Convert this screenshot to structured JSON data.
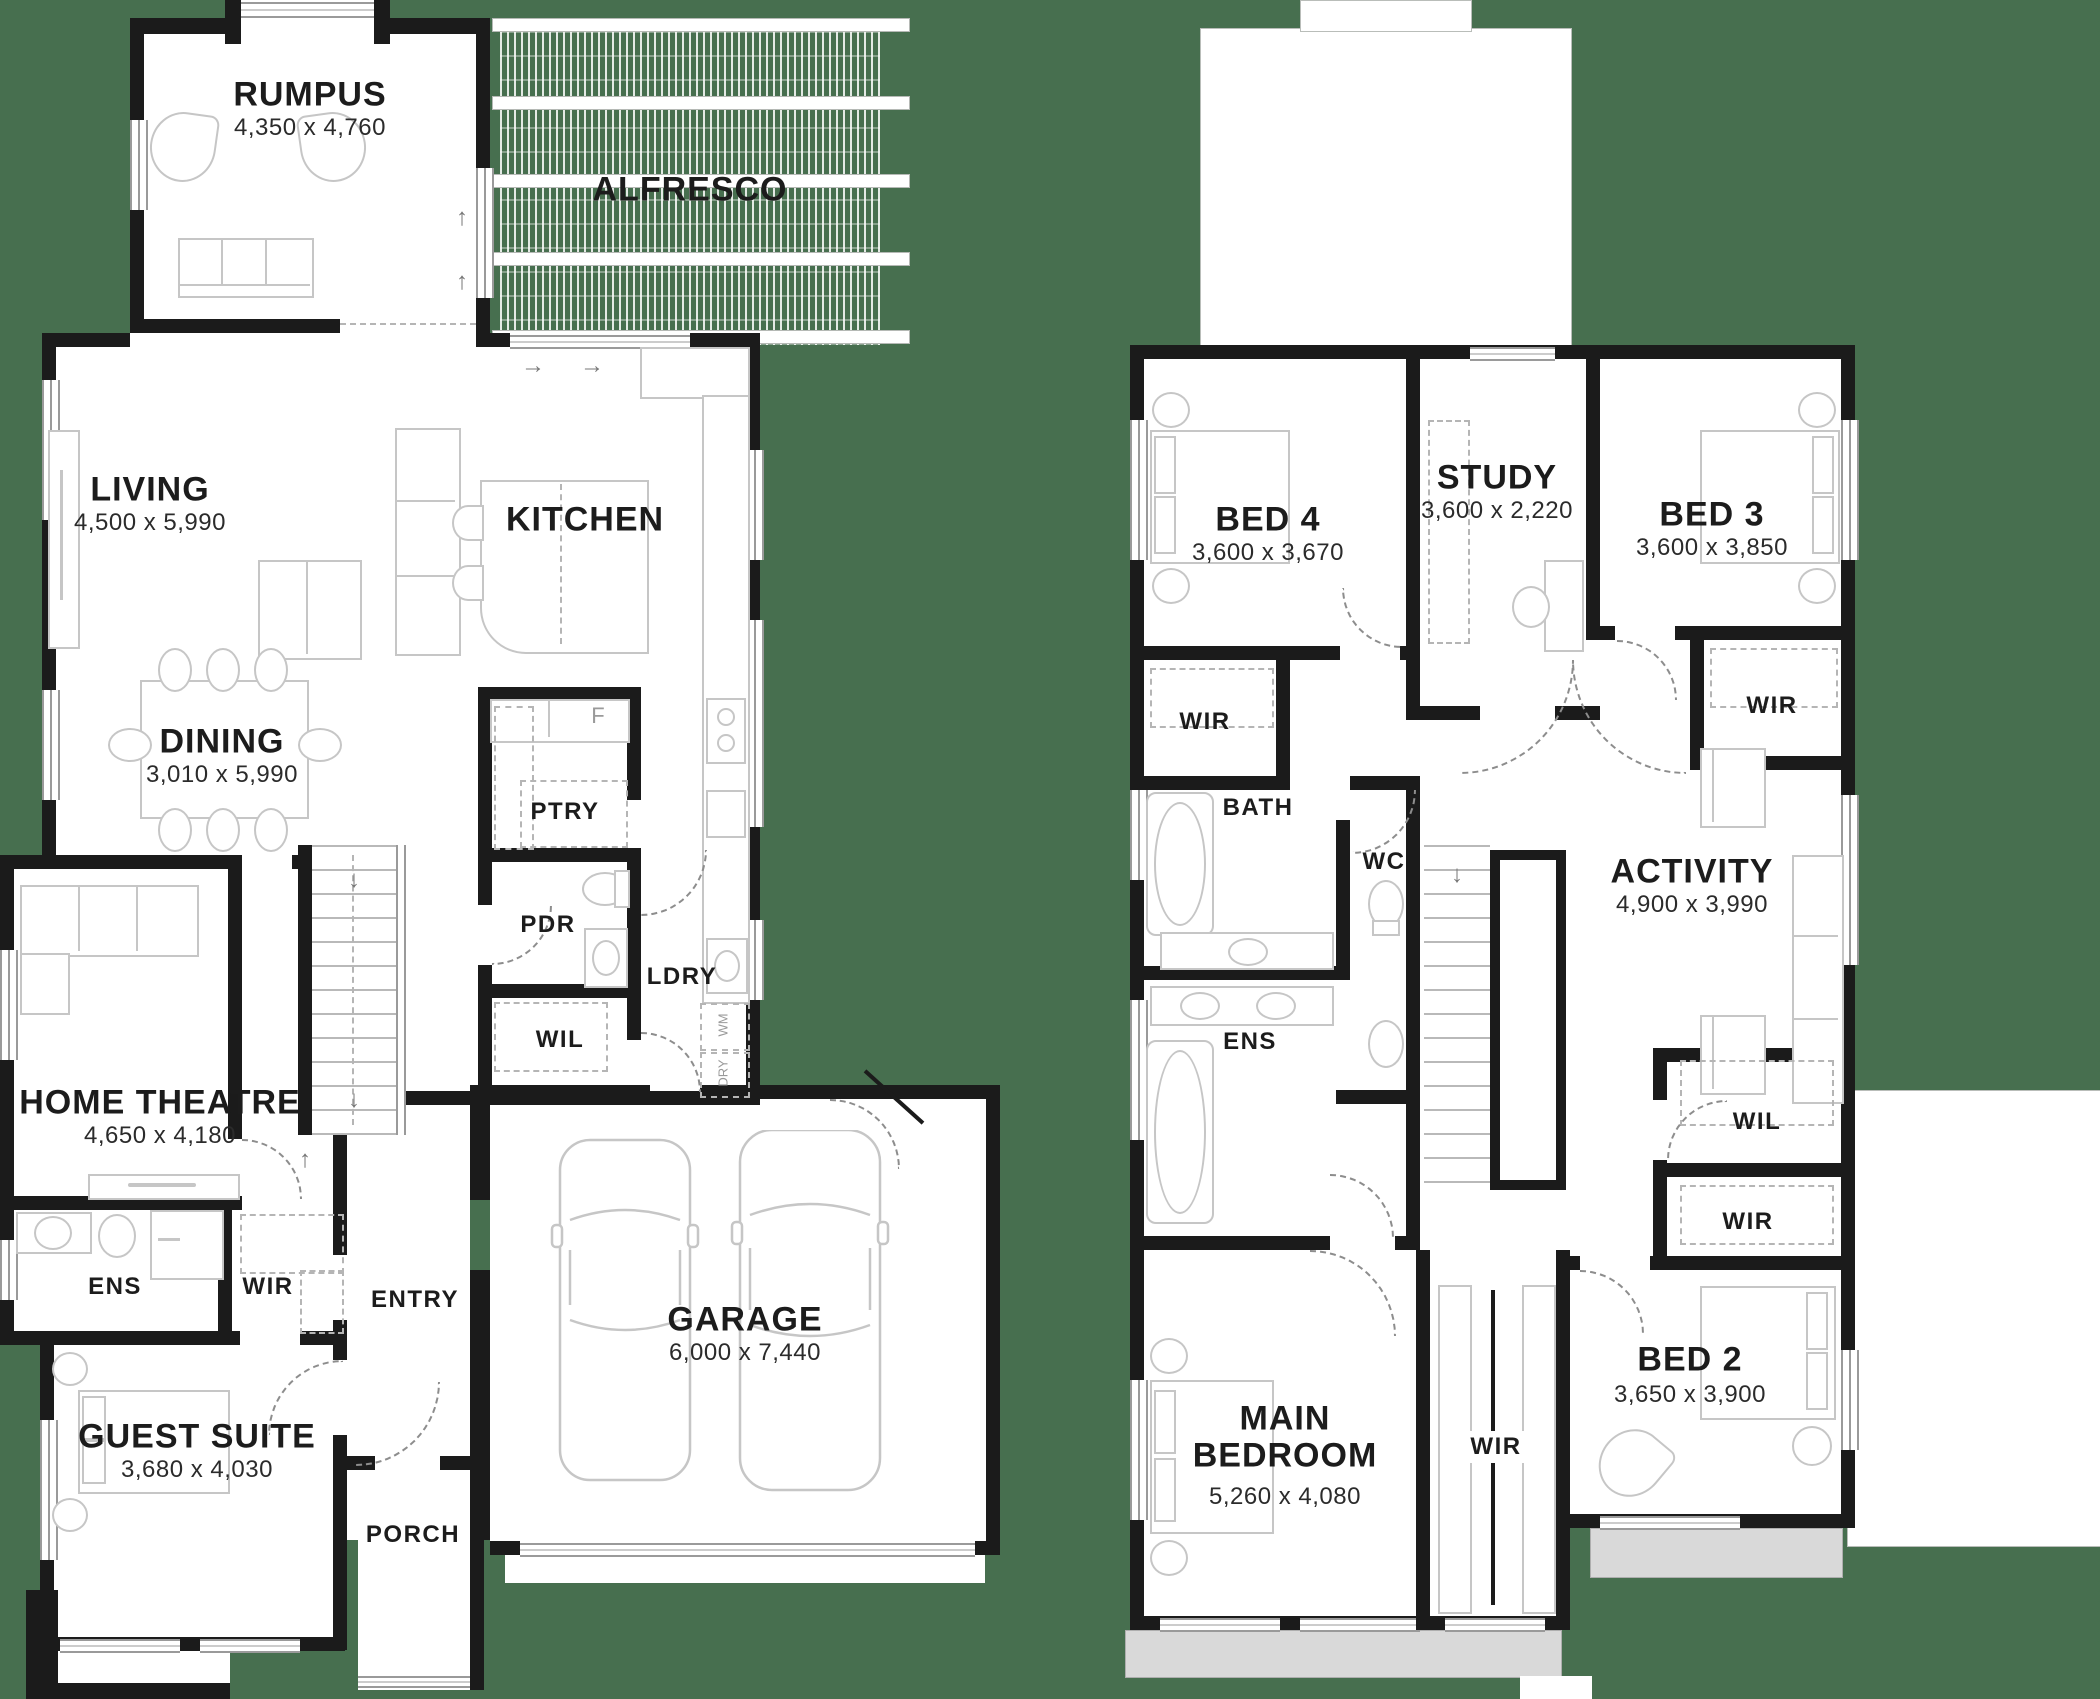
{
  "colors": {
    "background": "#476f4f",
    "wall": "#1b1b1b",
    "floor": "#ffffff",
    "furniture_line": "#c6c6c6",
    "veranda": "#d9d9d9"
  },
  "ground_floor": {
    "rumpus": {
      "name": "RUMPUS",
      "dims": "4,350 x 4,760"
    },
    "alfresco": {
      "name": "ALFRESCO"
    },
    "living": {
      "name": "LIVING",
      "dims": "4,500 x 5,990"
    },
    "dining": {
      "name": "DINING",
      "dims": "3,010 x 5,990"
    },
    "kitchen": {
      "name": "KITCHEN"
    },
    "fridge": {
      "name": "F"
    },
    "pantry": {
      "name": "PTRY"
    },
    "powder": {
      "name": "PDR"
    },
    "laundry": {
      "name": "LDRY"
    },
    "washer": {
      "name": "WM"
    },
    "dryer": {
      "name": "DRY"
    },
    "linen": {
      "name": "WIL"
    },
    "home_theatre": {
      "name": "HOME THEATRE",
      "dims": "4,650 x 4,180"
    },
    "ensuite": {
      "name": "ENS"
    },
    "wardrobe": {
      "name": "WIR"
    },
    "entry": {
      "name": "ENTRY"
    },
    "guest_suite": {
      "name": "GUEST SUITE",
      "dims": "3,680 x 4,030"
    },
    "porch": {
      "name": "PORCH"
    },
    "garage": {
      "name": "GARAGE",
      "dims": "6,000 x 7,440"
    }
  },
  "first_floor": {
    "bed4": {
      "name": "BED 4",
      "dims": "3,600 x 3,670"
    },
    "study": {
      "name": "STUDY",
      "dims": "3,600 x 2,220"
    },
    "bed3": {
      "name": "BED 3",
      "dims": "3,600 x 3,850"
    },
    "wir_bed4": {
      "name": "WIR"
    },
    "wir_bed3": {
      "name": "WIR"
    },
    "bath": {
      "name": "BATH"
    },
    "wc": {
      "name": "WC"
    },
    "activity": {
      "name": "ACTIVITY",
      "dims": "4,900 x 3,990"
    },
    "ensuite": {
      "name": "ENS"
    },
    "linen": {
      "name": "WIL"
    },
    "wir_right": {
      "name": "WIR"
    },
    "main_bedroom": {
      "name": "MAIN BEDROOM",
      "dims": "5,260 x 4,080"
    },
    "wir_main": {
      "name": "WIR"
    },
    "bed2": {
      "name": "BED 2",
      "dims": "3,650 x 3,900"
    }
  }
}
